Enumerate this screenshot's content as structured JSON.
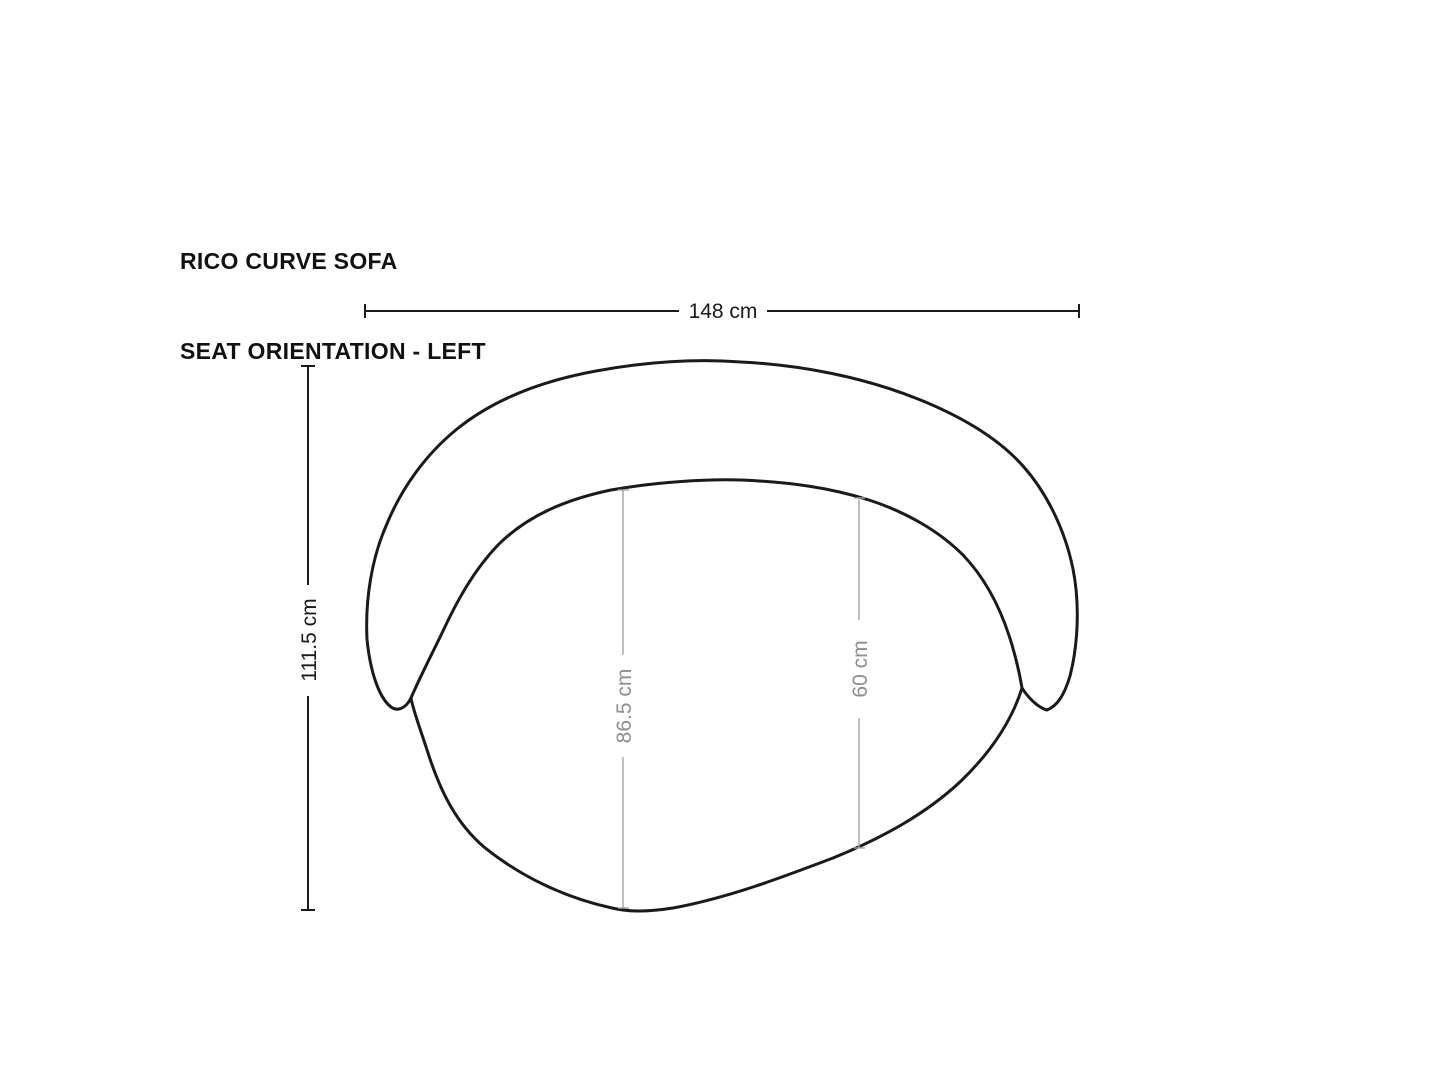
{
  "title": {
    "line1": "RICO CURVE SOFA",
    "line2": "SEAT ORIENTATION - LEFT"
  },
  "dimensions": {
    "overall_width": "148 cm",
    "overall_depth": "111.5 cm",
    "inner_depth": "86.5 cm",
    "inner_seat_width": "60 cm"
  },
  "colors": {
    "background": "#ffffff",
    "outline": "#1a1a1a",
    "dimension_black": "#1a1a1a",
    "dimension_gray_line": "#a6a6a6",
    "dimension_gray_text": "#8e8e8e",
    "title_text": "#111111"
  }
}
